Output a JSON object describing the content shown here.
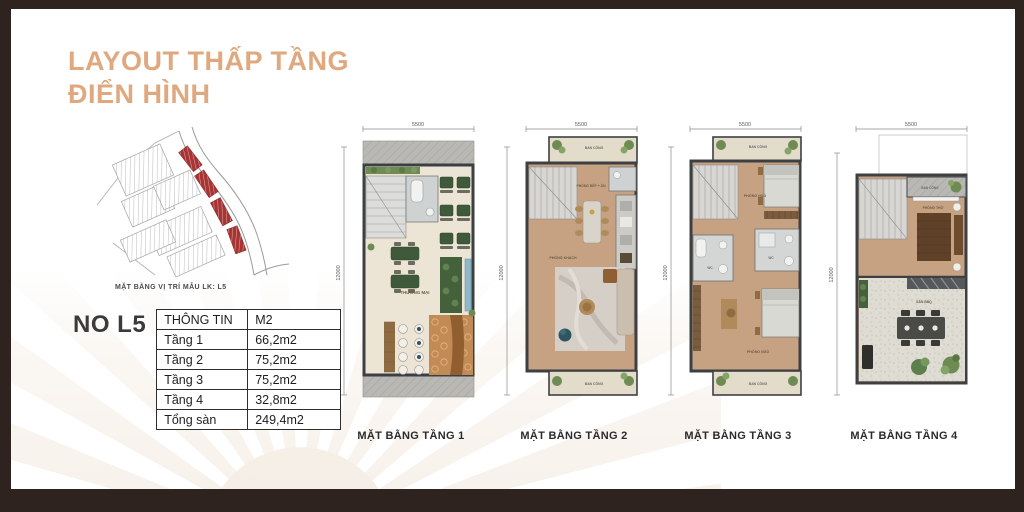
{
  "header": {
    "title_line1": "LAYOUT THẤP TẦNG",
    "title_line2": "ĐIỂN HÌNH"
  },
  "site_map": {
    "caption": "MẶT BẰNG VỊ TRÍ MẪU LK: L5"
  },
  "unit_info": {
    "unit_label": "NO L5",
    "table": {
      "header": {
        "col1": "THÔNG TIN",
        "col2": "M2"
      },
      "rows": [
        {
          "label": "Tầng 1",
          "area": "66,2m2"
        },
        {
          "label": "Tầng 2",
          "area": "75,2m2"
        },
        {
          "label": "Tầng 3",
          "area": "75,2m2"
        },
        {
          "label": "Tầng 4",
          "area": "32,8m2"
        },
        {
          "label": "Tổng sàn",
          "area": "249,4m2"
        }
      ]
    }
  },
  "floor_plans": [
    {
      "caption": "MẶT BẰNG TẦNG 1",
      "top_dim": "5500",
      "side_dim": "12000",
      "rooms": {
        "main": "THƯƠNG MẠI"
      }
    },
    {
      "caption": "MẶT BẰNG TẦNG 2",
      "top_dim": "5500",
      "side_dim": "12000",
      "rooms": {
        "balcony_top": "BAN CÔNG",
        "kitchen_dining": "PHÒNG BẾP + ĂN",
        "living": "PHÒNG KHÁCH",
        "balcony_bottom": "BAN CÔNG"
      }
    },
    {
      "caption": "MẶT BẰNG TẦNG 3",
      "top_dim": "5500",
      "side_dim": "12000",
      "rooms": {
        "balcony_top": "BAN CÔNG",
        "bedroom1": "PHÒNG NGỦ",
        "wc1": "WC",
        "wc2": "WC",
        "bedroom2": "PHÒNG NGỦ",
        "balcony_bottom": "BAN CÔNG"
      }
    },
    {
      "caption": "MẶT BẰNG TẦNG 4",
      "top_dim": "5500",
      "side_dim": "12000",
      "rooms": {
        "balcony_top": "BAN CÔNG",
        "worship": "PHÒNG THỜ",
        "bbq": "SÂN BBQ"
      }
    }
  ],
  "colors": {
    "accent_tan": "#dfa87e",
    "frame_brown": "#2f2320",
    "lot_highlight_red": "#a83434",
    "wall_dark": "#3d4043",
    "floor_tan": "#c6a283",
    "floor_cream": "#ece4d4"
  }
}
